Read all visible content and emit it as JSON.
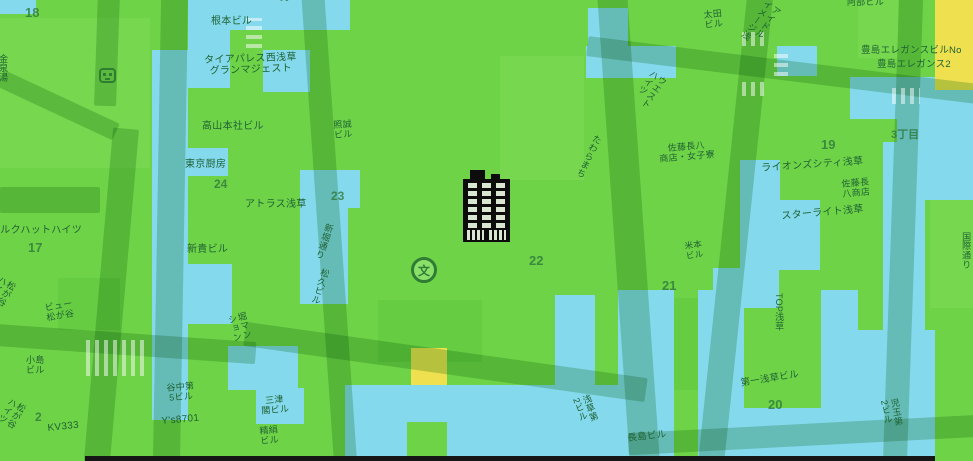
{
  "map": {
    "palette": {
      "overlay_green": "#6fd348",
      "overlay_green_light": "#77d84f",
      "overlay_green_dark": "#66cc42",
      "overlay_cyan": "#84d9ec",
      "overlay_yellow": "#eee04f",
      "road_tint": "#c3dcc5",
      "label_color": "#1f6233",
      "number_color": "#2e783c",
      "building_marker_color": "#0c0c0c",
      "building_window_color": "#d9e6d2",
      "icon_green": "#2e7d33",
      "bottom_bar_color": "#161616"
    },
    "markers": {
      "building_marker": "office-building illustration, black with lit windows",
      "school_marker": "文 school map symbol in circle",
      "metro_station": "train-station icon"
    },
    "school_marker_glyph": "文",
    "labels": [
      {
        "name": "block-18",
        "text": "18"
      },
      {
        "name": "clipped-top-label",
        "text": "男"
      },
      {
        "name": "nemoto-bldg",
        "text": "根本ビル"
      },
      {
        "name": "tiara-palace-nishi-asakusa",
        "lines": [
          "タイアパレス西浅草",
          "グランマジェスト"
        ]
      },
      {
        "name": "takayama-honsha-bldg",
        "text": "高山本社ビル"
      },
      {
        "name": "tokyo-chubo",
        "text": "東京厨房"
      },
      {
        "name": "block-24",
        "text": "24"
      },
      {
        "name": "atlas-asakusa",
        "text": "アトラス浅草"
      },
      {
        "name": "shinki-bldg",
        "text": "新貴ビル"
      },
      {
        "name": "silkhat-heights",
        "text": "シルクハットハイツ"
      },
      {
        "name": "block-17",
        "text": "17"
      },
      {
        "name": "shosei-bldg",
        "lines": [
          "照誠",
          "ビル"
        ]
      },
      {
        "name": "block-23",
        "text": "23"
      },
      {
        "name": "shinbori-dori",
        "text": "新堀通り"
      },
      {
        "name": "matsuhisa-bldg",
        "text": "松久ビル"
      },
      {
        "name": "block-22",
        "text": "22"
      },
      {
        "name": "tawaramachi-street",
        "text": "たわらまち"
      },
      {
        "name": "block-19",
        "text": "19"
      },
      {
        "name": "chome-3",
        "text": "3丁目"
      },
      {
        "name": "ota-bldg",
        "lines": [
          "太田",
          "ビル"
        ]
      },
      {
        "name": "idol-image-asakusa",
        "lines": [
          "アイドル",
          "イメージ浅"
        ]
      },
      {
        "name": "abe-bldg",
        "text": "阿部ビル"
      },
      {
        "name": "toshima-elegance-bldg-no",
        "text": "豊島エレガンスビルNo"
      },
      {
        "name": "toshima-elegance-2",
        "text": "豊島エレガンス2"
      },
      {
        "name": "west-heights",
        "lines": [
          "ウエスト",
          "ハイツ"
        ]
      },
      {
        "name": "sato-chohachi-dorm",
        "lines": [
          "佐藤長八",
          "商店・女子寮"
        ]
      },
      {
        "name": "lions-city-asakusa",
        "text": "ライオンズシティ浅草"
      },
      {
        "name": "sato-chohachi-shop",
        "lines": [
          "佐藤長",
          "八商店"
        ]
      },
      {
        "name": "starlight-asakusa",
        "text": "スターライト浅草"
      },
      {
        "name": "kokusai-dori-clipped",
        "text": "国際通り"
      },
      {
        "name": "block-21",
        "text": "21"
      },
      {
        "name": "yonemoto-bldg",
        "lines": [
          "米本",
          "ビル"
        ]
      },
      {
        "name": "top-asakusa",
        "text": "TOP浅草"
      },
      {
        "name": "daiichi-asakusa-bldg",
        "text": "第一浅草ビル"
      },
      {
        "name": "block-20",
        "text": "20"
      },
      {
        "name": "nagashima-bldg",
        "text": "長島ビル"
      },
      {
        "name": "asakusa-dai2-bldg",
        "lines": [
          "浅草第",
          "2ビル"
        ]
      },
      {
        "name": "kodama-dai2-bldg",
        "lines": [
          "児玉第",
          "2ビル"
        ]
      },
      {
        "name": "hori-mansion",
        "lines": [
          "堀マン",
          "ション"
        ]
      },
      {
        "name": "yanaka-dai5-bldg",
        "lines": [
          "谷中第",
          "5ビル"
        ]
      },
      {
        "name": "ys8701",
        "text": "Y's8701"
      },
      {
        "name": "mitsukaku-bldg",
        "lines": [
          "三津",
          "閣ビル"
        ]
      },
      {
        "name": "seiken-bldg",
        "lines": [
          "精絹",
          "ビル"
        ]
      },
      {
        "name": "kojima-bldg",
        "lines": [
          "小島",
          "ビル"
        ]
      },
      {
        "name": "block-2",
        "text": "2"
      },
      {
        "name": "kv333",
        "text": "KV333"
      },
      {
        "name": "view-matsugaya",
        "lines": [
          "ビュー",
          "松が谷"
        ]
      },
      {
        "name": "matsugaya-heights-north",
        "lines": [
          "松が谷",
          "ハイツ"
        ]
      },
      {
        "name": "matsugaya-heights-south",
        "lines": [
          "松が谷",
          "ハイツ"
        ]
      },
      {
        "name": "kinsen-yu",
        "text": "金泉湯"
      }
    ]
  }
}
